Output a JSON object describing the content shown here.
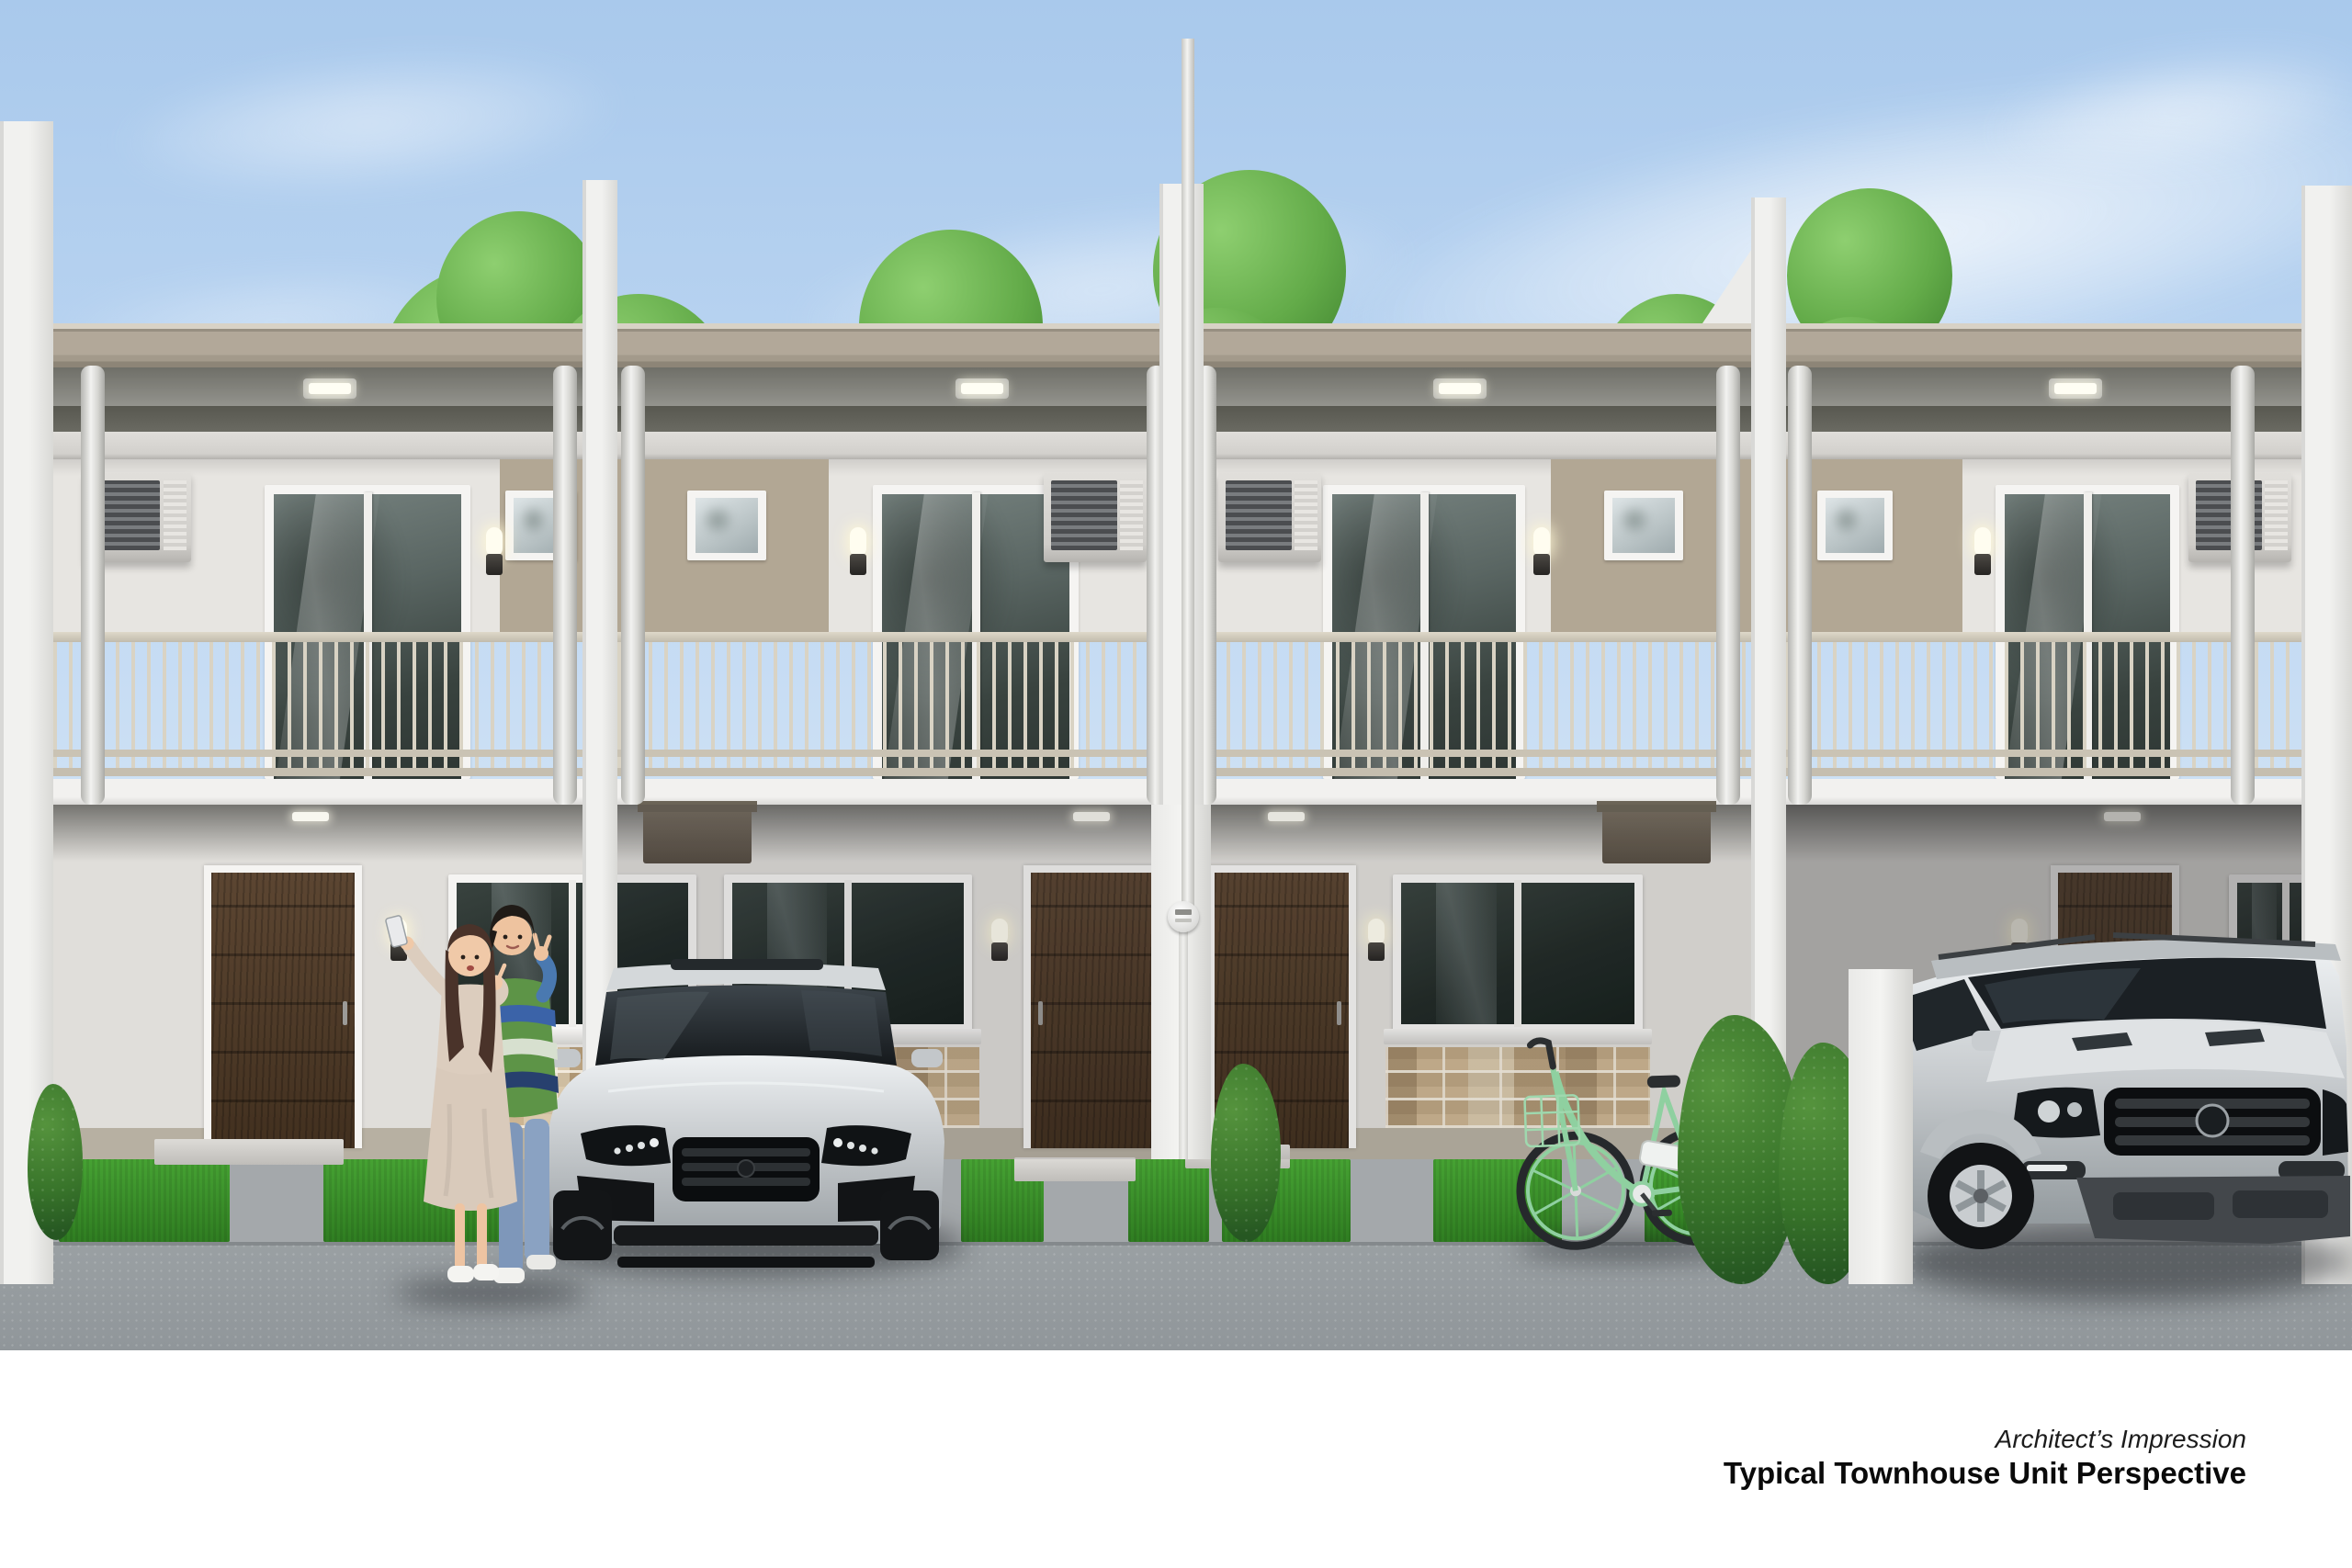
{
  "caption": {
    "line1": "Architect’s Impression",
    "line2": "Typical Townhouse Unit Perspective"
  },
  "scene": {
    "type": "architectural exterior rendering",
    "subject": "row of four identical two-storey townhouse units, flat roof, balconies with metal railings",
    "objects": [
      "sky with soft clouds",
      "trees behind roofline",
      "tan roof fascia",
      "recessed soffit lights",
      "white party fin walls",
      "round porch columns",
      "central utility pole with electric meter",
      "upper-floor sliding glass doors",
      "small square windows",
      "window-type air conditioners",
      "cylindrical wall sconces",
      "champagne balcony railings",
      "dark walnut entry doors",
      "ground-floor sliding windows",
      "stone veneer wainscot",
      "grass strips with concrete pavers",
      "concrete driveway and road",
      "couple taking a selfie",
      "silver SUV parked left",
      "silver SUV parked right",
      "mint green bicycle",
      "trimmed hedges and shrubs"
    ]
  },
  "colors": {
    "sky_top": "#a9c9ec",
    "sky_bottom": "#d9e8f7",
    "fascia": "#b2a899",
    "base_wall": "#e7e5e1",
    "accent_wall": "#b2a794",
    "ground_wall": "#e0deda",
    "plinth": "#b7b0a2",
    "stone": "#c7b393",
    "door_wood": "#5c4632",
    "grass": "#46a233",
    "walkway": "#a4a8ab",
    "road": "#9aa0a3",
    "hedge": "#265722",
    "bike_mint": "#8fd0a0",
    "suv_silver": "#c8ccce",
    "caption_ink": "#0a0a0a"
  }
}
